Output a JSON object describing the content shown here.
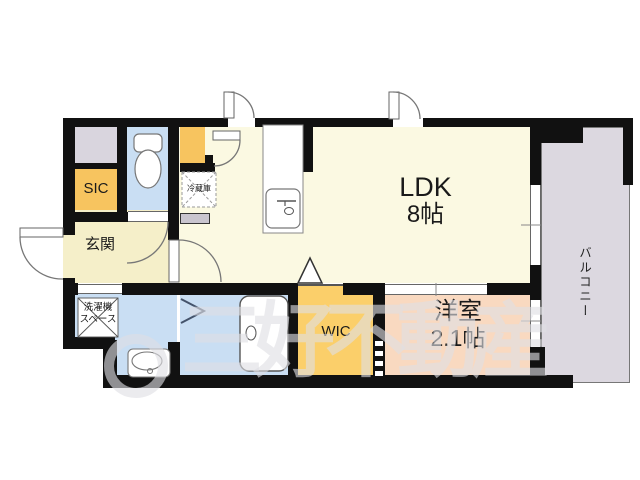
{
  "rooms": {
    "ldk": {
      "label": "LDK",
      "size": "8帖"
    },
    "western": {
      "label": "洋室",
      "size": "2.1帖"
    },
    "wic": {
      "label": "WIC"
    },
    "sic": {
      "label": "SIC"
    },
    "entrance": {
      "label": "玄関"
    },
    "laundry": {
      "line1": "洗濯機",
      "line2": "スペース"
    },
    "refrigerator": {
      "label": "冷蔵庫"
    },
    "balcony": {
      "label": "バルコニー"
    }
  },
  "watermark": {
    "text": "三好不動産"
  },
  "colors": {
    "wall": "#111111",
    "ldk_floor": "#fbf9e2",
    "hall_floor": "#f5efc9",
    "wet_area_floor": "#c9def3",
    "storage_orange": "#f7c45f",
    "wic_orange": "#fbcf6a",
    "western_room_pink": "#f9d9c0",
    "gray_closet": "#d9d5de",
    "balcony_gray": "#dcd8e0",
    "watermark_gray": "rgba(222,222,227,0.62)"
  }
}
